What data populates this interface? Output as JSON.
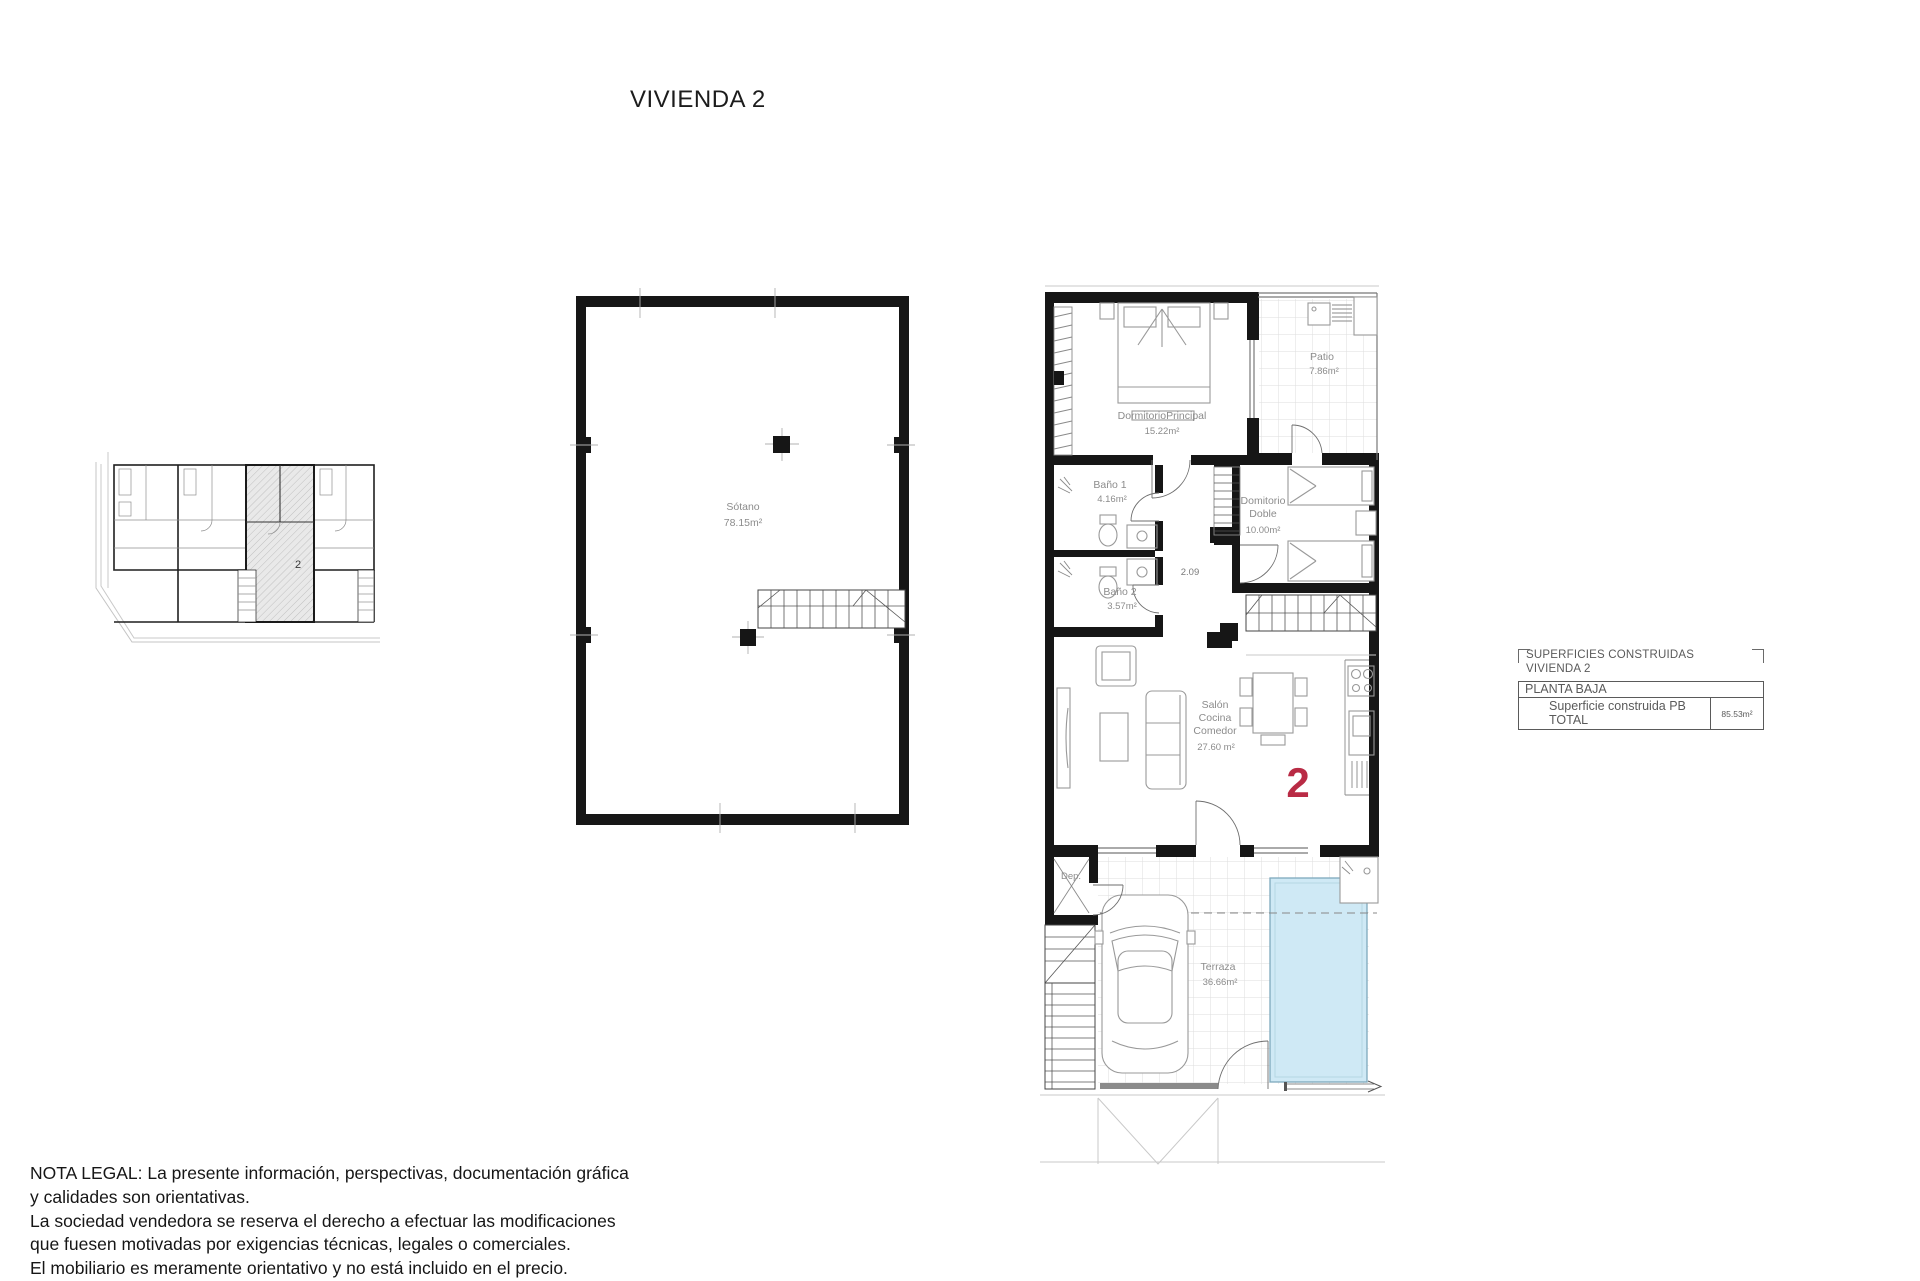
{
  "title": "VIVIENDA 2",
  "colors": {
    "pool_fill": "#cfe9f5",
    "pool_border": "#7ea9bd",
    "accent_red": "#b92b45",
    "wall": "#161616",
    "label_gray": "#8c8c8c"
  },
  "site_plan": {
    "unit_label": "2"
  },
  "basement": {
    "room_name": "Sótano",
    "room_area": "78.15m²"
  },
  "ground_floor": {
    "unit_number": "2",
    "corridor_dimension": "2.09",
    "rooms": {
      "dormitorio_principal": {
        "line1": "DormitorioPrincipal",
        "area": "15.22m²"
      },
      "patio": {
        "line1": "Patio",
        "area": "7.86m²"
      },
      "bano1": {
        "line1": "Baño 1",
        "area": "4.16m²"
      },
      "dormitorio_doble": {
        "line1": "Domitorio",
        "line2": "Doble",
        "area": "10.00m²"
      },
      "bano2": {
        "line1": "Baño 2",
        "area": "3.57m²"
      },
      "salon": {
        "line1": "Salón",
        "line2": "Cocina",
        "line3": "Comedor",
        "area": "27.60 m²"
      },
      "dep": {
        "line1": "Dep."
      },
      "terraza": {
        "line1": "Terraza",
        "area": "36.66m²"
      }
    }
  },
  "summary_table": {
    "header_line1": "SUPERFICIES CONSTRUIDAS",
    "header_line2": "VIVIENDA 2",
    "section_row": "PLANTA BAJA",
    "total_label": "Superficie construida PB TOTAL",
    "total_value": "85.53m²"
  },
  "legal_note": {
    "lines": [
      "NOTA LEGAL: La presente información, perspectivas, documentación gráfica",
      "y calidades son orientativas.",
      "La sociedad vendedora se reserva el derecho a efectuar las modificaciones",
      "que fuesen motivadas por exigencias técnicas, legales o comerciales.",
      "El mobiliario es meramente orientativo y no está incluido en el precio."
    ]
  }
}
